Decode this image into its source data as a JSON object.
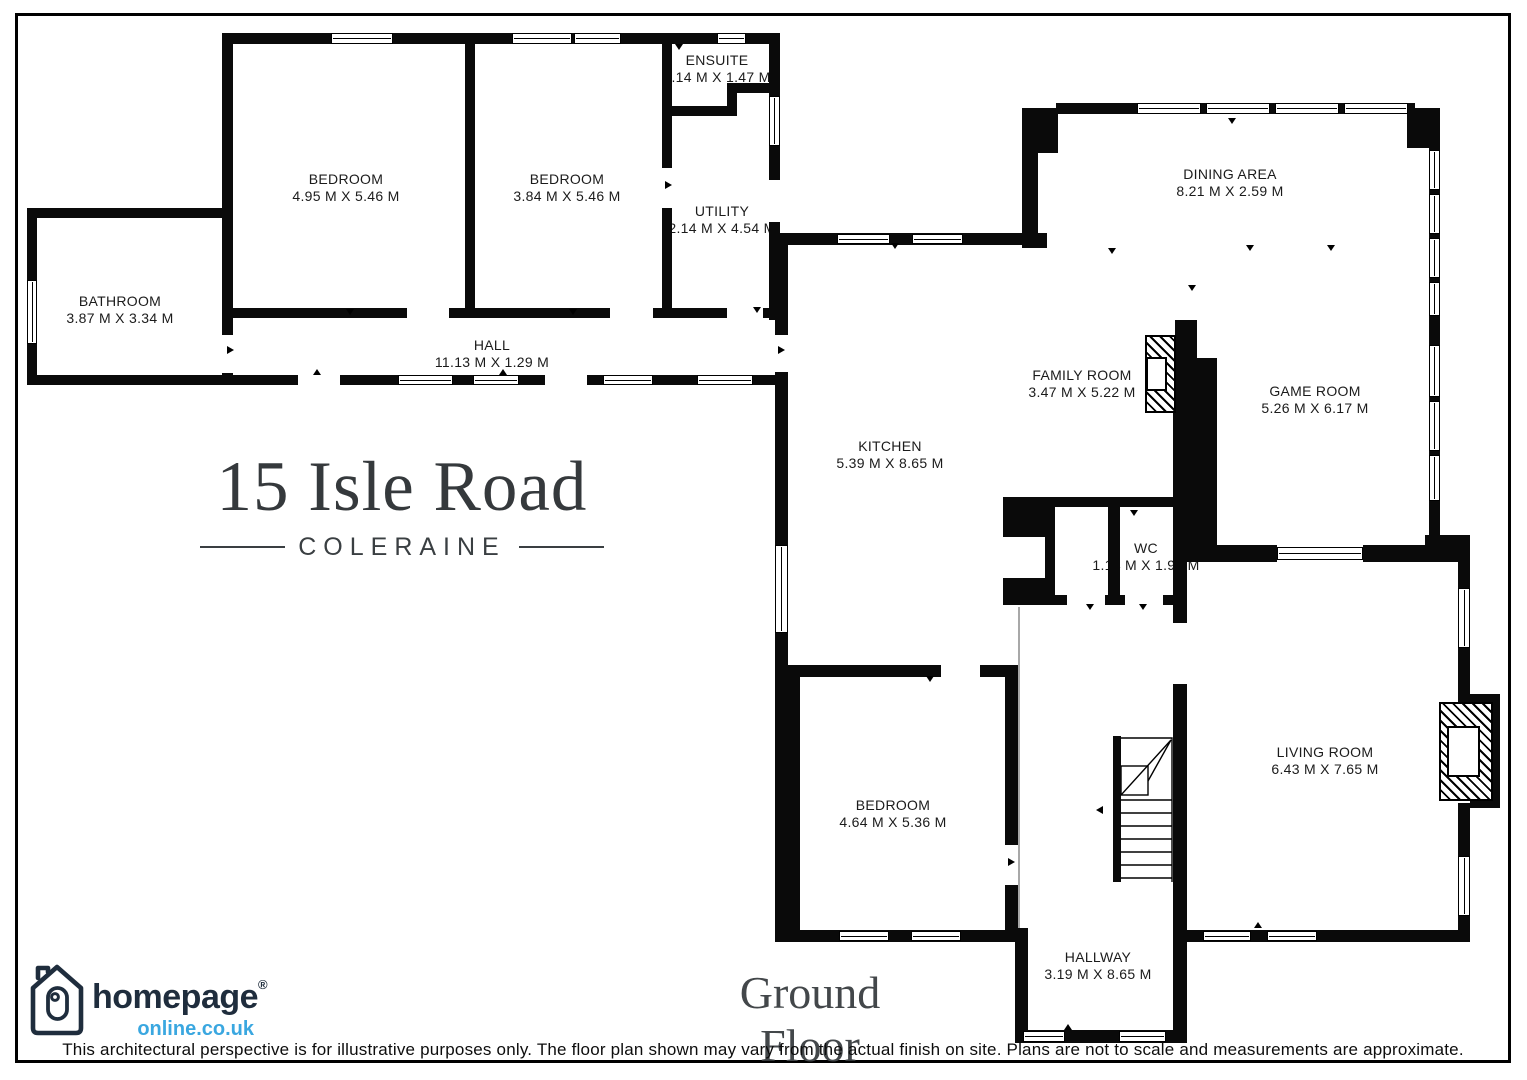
{
  "page": {
    "title_line1": "15 Isle Road",
    "title_line2": "COLERAINE",
    "floor_label": "Ground Floor",
    "disclaimer": "This architectural perspective is for illustrative purposes only. The floor plan shown may vary from the actual finish on site. Plans are not to scale and measurements are approximate."
  },
  "logo": {
    "brand": "homepage",
    "registered_mark": "®",
    "domain": "online.co.uk",
    "brand_color": "#1f2d3d",
    "domain_color": "#3aa7e0"
  },
  "rooms": [
    {
      "id": "bedroom-1",
      "name": "BEDROOM",
      "dims": "4.95 M X 5.46 M"
    },
    {
      "id": "bedroom-2",
      "name": "BEDROOM",
      "dims": "3.84 M X 5.46 M"
    },
    {
      "id": "ensuite",
      "name": "ENSUITE",
      "dims": "2.14 M X 1.47 M"
    },
    {
      "id": "utility",
      "name": "UTILITY",
      "dims": "2.14 M X 4.54 M"
    },
    {
      "id": "bathroom",
      "name": "BATHROOM",
      "dims": "3.87 M X 3.34 M"
    },
    {
      "id": "hall",
      "name": "HALL",
      "dims": "11.13 M X 1.29 M"
    },
    {
      "id": "dining-area",
      "name": "DINING AREA",
      "dims": "8.21 M X 2.59 M"
    },
    {
      "id": "family-room",
      "name": "FAMILY ROOM",
      "dims": "3.47 M X 5.22 M"
    },
    {
      "id": "game-room",
      "name": "GAME ROOM",
      "dims": "5.26 M X 6.17 M"
    },
    {
      "id": "kitchen",
      "name": "KITCHEN",
      "dims": "5.39 M X 8.65 M"
    },
    {
      "id": "wc",
      "name": "WC",
      "dims": "1.14 M X 1.91 M"
    },
    {
      "id": "living-room",
      "name": "LIVING ROOM",
      "dims": "6.43 M X 7.65 M"
    },
    {
      "id": "bedroom-3",
      "name": "BEDROOM",
      "dims": "4.64 M X 5.36 M"
    },
    {
      "id": "hallway",
      "name": "HALLWAY",
      "dims": "3.19 M X 8.65 M"
    }
  ]
}
